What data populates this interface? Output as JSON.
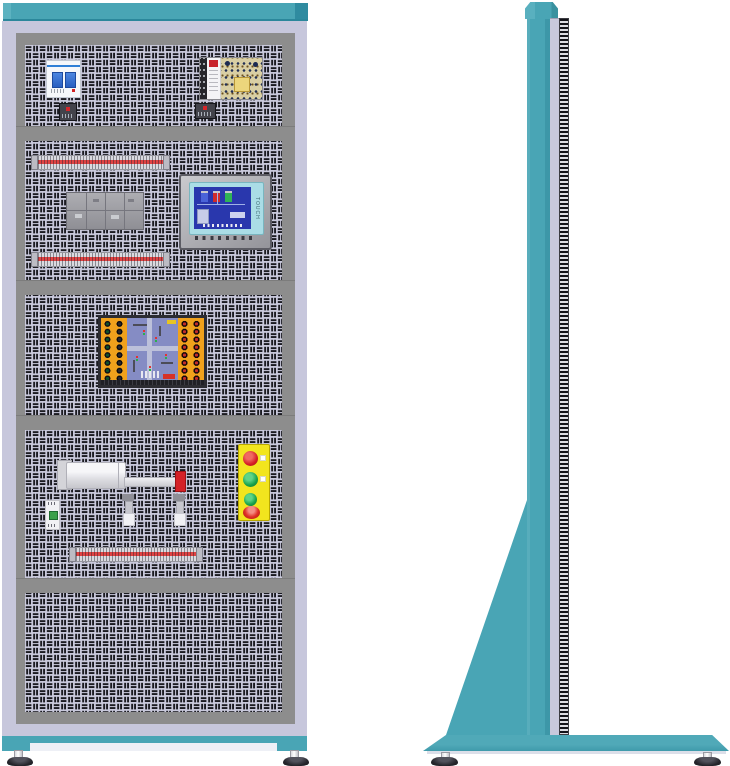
{
  "hmi": {
    "screen_text": "TOUCH"
  },
  "colors": {
    "teal": "#49A5B5",
    "teal_dark": "#2F8BA0",
    "frame_lavender": "#C7C7DC",
    "bezel_gray": "#8D8D8D",
    "panel_background": "#C9C9DC",
    "panel_slot": "#1B1B21",
    "station_yellow": "#F2E51E",
    "button_red": "#D61F26",
    "button_green": "#18A24B",
    "board_orange": "#F0A11C",
    "board_blue": "#858CC4",
    "hmi_screen_blue": "#2937AD",
    "psu_pcb": "#D9CFA4",
    "cylinder_tip_red": "#D42127"
  },
  "equipment": {
    "front": [
      "top-cap",
      "perforated-tool-panel",
      "circuit-breaker",
      "mini-terminal-block-left",
      "switching-power-supply",
      "mini-terminal-block-right",
      "terminal-strip-top",
      "plc-relay-module-group",
      "hmi-touch-panel",
      "terminal-strip-middle",
      "traffic-light-training-board",
      "pneumatic-cylinder",
      "micro-switch",
      "proximity-sensor-1",
      "proximity-sensor-2",
      "push-button-station",
      "terminal-strip-bottom",
      "leveling-foot-left",
      "leveling-foot-right"
    ],
    "side": [
      "top-cap",
      "cabinet-column",
      "panel-edge-louvers",
      "support-gusset",
      "base-plate",
      "leveling-foot-front",
      "leveling-foot-rear"
    ]
  },
  "push_button_station": {
    "buttons": [
      "red",
      "green",
      "green",
      "emergency-stop"
    ]
  }
}
